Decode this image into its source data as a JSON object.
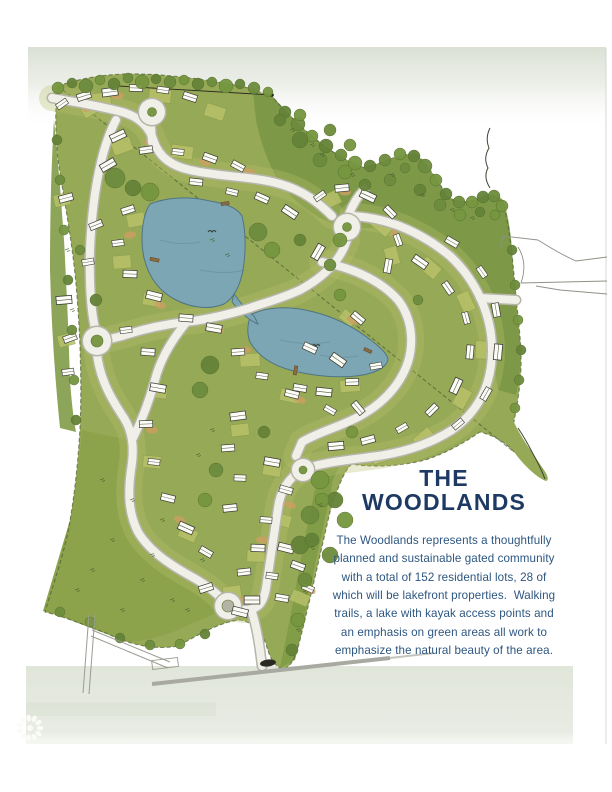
{
  "panel": {
    "title_line1": "THE",
    "title_line2": "WOODLANDS",
    "description_lines": [
      "The Woodlands represents a thoughtfully",
      "planned and sustainable gated community",
      "with a total of 152 residential lots, 28 of",
      "which will be lakefront properties.  Walking",
      "trails, a lake with kayak access points and",
      "an emphasis on green areas all work to",
      "emphasize the natural beauty of the area."
    ]
  },
  "colors": {
    "accent_navy": "#1e3a64",
    "body_blue": "#2d5680",
    "map_green": "#96a957",
    "forest_green": "#7b9846",
    "meadow_green": "#8ca34c",
    "lot_green": "#b7c169",
    "lake_blue": "#7ca6b4",
    "road_fill": "#f0efe8",
    "road_edge": "#b5b5aa",
    "tan": "#cd9f62",
    "band": "#dde2d5"
  }
}
